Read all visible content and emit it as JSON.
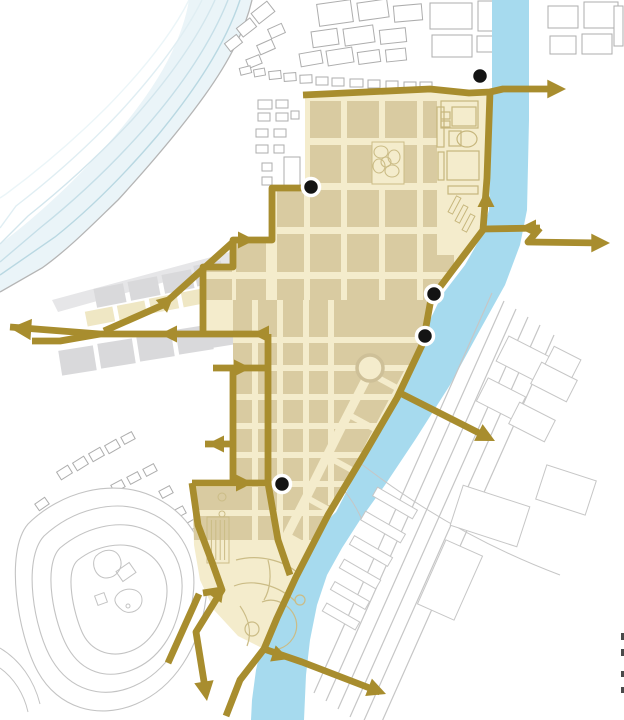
{
  "canvas": {
    "w": 624,
    "h": 720,
    "bg": "#FFFFFF"
  },
  "palette": {
    "route_gold": "#A88D2E",
    "river_blue": "#A6DAEE",
    "zone_cream": "#F4ECCC",
    "block_tan": "#D9CBA1",
    "block_gray": "#D9D9DB",
    "pier_wedge": "#E6E6E8",
    "block_beige": "#EFE7C4",
    "outline_gray": "#ADADAD",
    "contour_gray": "#C3C3C3",
    "rail_gray": "#C6C6C6",
    "feature_tan": "#CBBC86",
    "ne_outline": "#C6B67C",
    "shore_gray": "#B5B5B5",
    "dot_black": "#141414",
    "dot_ring": "#FFFFFF",
    "edge_mark": "#4A4A4A",
    "bay_fill": "#EAF4F8",
    "bay_blues": [
      "#B9D8E2",
      "#C6DFE8",
      "#D3E6ED",
      "#E0EEF3",
      "#EBF5F8"
    ]
  },
  "bay": {
    "fill_band": "M252,0 C245,30 230,60 205,95 C180,130 150,165 118,200 C95,222 70,248 42,268 L0,292 L0,244 C30,222 65,190 95,158 C125,126 155,88 172,52 C180,35 186,18 189,0 Z",
    "shoreline": "M252,0 C245,30 230,60 205,95 C180,130 150,165 118,200 C95,222 70,248 42,268 L0,292",
    "contours": [
      "M240,0 C225,45 195,90 158,135 C130,168 95,205 55,237 L0,275",
      "M228,0 C210,45 180,88 145,128 C115,162 80,196 40,228 L0,262",
      "M215,0 C196,42 166,82 132,120 C104,150 68,184 28,216 L0,244",
      "M202,0 C183,38 153,76 120,112 C92,142 55,176 16,206 L0,228",
      "M189,0 C171,36 141,72 108,106 C80,134 44,166 6,194 L0,198"
    ]
  },
  "river": {
    "path": "M492,0 L492,120 L489,210 L482,235 L465,265 L442,295 L430,320 L420,350 L398,395 L368,450 L336,512 L312,535 L294,558 L282,585 L272,612 L263,640 L256,670 L252,700 L251,720 L304,720 L306,675 L310,640 L317,605 L327,575 L342,548 L360,520 L385,485 L415,440 L450,385 L480,330 L505,285 L520,245 L527,210 L529,120 L529,0 Z"
  },
  "zone": {
    "outline": "305,92 490,92 487,178 483,230 452,271 431,299 423,343 397,398 362,458 328,515 296,577 277,618 264,649 238,636 214,610 200,580 194,545 192,483 233,483 233,336 203,336 203,267 233,267 233,240 272,240 272,188 305,188",
    "upper_cols": [
      [
        206,
        26
      ],
      [
        236,
        30
      ],
      [
        277,
        27
      ],
      [
        310,
        31
      ],
      [
        347,
        32
      ],
      [
        385,
        32
      ],
      [
        423,
        31
      ]
    ],
    "upper_rows": [
      [
        101,
        37
      ],
      [
        145,
        38
      ],
      [
        190,
        37
      ],
      [
        234,
        38
      ],
      [
        279,
        21
      ]
    ],
    "lower_fill": "233,300 431,300 423,343 397,398 362,458 330,510 312,540 194,540 192,483 233,483",
    "streets_v": [
      [
        255,
        300,
        540
      ],
      [
        280,
        300,
        540
      ],
      [
        306,
        300,
        540
      ],
      [
        331,
        300,
        505
      ]
    ],
    "streets_h": [
      [
        340,
        192,
        430
      ],
      [
        368,
        192,
        430
      ],
      [
        397,
        192,
        420
      ],
      [
        426,
        192,
        410
      ],
      [
        455,
        192,
        395
      ],
      [
        484,
        192,
        370
      ],
      [
        513,
        194,
        340
      ]
    ],
    "diag_avenues": [
      {
        "d": "M377,358 L341,428 L306,498 L282,545",
        "w": 9
      },
      {
        "d": "M409,368 L371,440 L339,503",
        "w": 6
      }
    ],
    "cross_streets": [
      "M373,375 L417,399",
      "M351,416 L395,440",
      "M330,458 L372,481",
      "M309,499 L349,521",
      "M290,537 L326,557"
    ]
  },
  "ne_area": {
    "rect": [
      437,
      95,
      52,
      160
    ],
    "shapes": [
      {
        "t": "rect",
        "v": [
          441,
          101,
          37,
          27
        ]
      },
      {
        "t": "rect",
        "v": [
          441,
          112,
          9,
          7
        ]
      },
      {
        "t": "rect",
        "v": [
          441,
          121,
          9,
          6
        ]
      },
      {
        "t": "rect",
        "v": [
          452,
          107,
          24,
          19
        ]
      },
      {
        "t": "ellipse",
        "v": [
          467,
          139,
          10,
          8
        ]
      },
      {
        "t": "rect",
        "v": [
          449,
          131,
          12,
          15
        ]
      },
      {
        "t": "rect",
        "v": [
          437,
          107,
          7,
          40
        ]
      },
      {
        "t": "rect",
        "v": [
          447,
          151,
          32,
          29
        ]
      },
      {
        "t": "rect",
        "v": [
          438,
          152,
          6,
          28
        ]
      },
      {
        "t": "rect",
        "v": [
          448,
          186,
          30,
          8
        ]
      }
    ],
    "hatch": [
      [
        452,
        196,
        5,
        18,
        28
      ],
      [
        459,
        205,
        5,
        18,
        28
      ],
      [
        466,
        214,
        5,
        18,
        28
      ]
    ]
  },
  "features": {
    "park_rect": [
      372,
      142,
      32,
      42
    ],
    "park_trees": [
      [
        381,
        152,
        7,
        6
      ],
      [
        394,
        157,
        6,
        7
      ],
      [
        379,
        166,
        6,
        7
      ],
      [
        392,
        171,
        7,
        6
      ],
      [
        386,
        162,
        5,
        5
      ]
    ],
    "plaza": [
      370,
      368,
      13
    ],
    "notch_building": [
      207,
      517,
      22,
      46
    ],
    "notch_circles": [
      [
        222,
        497,
        4
      ],
      [
        222,
        514,
        3
      ]
    ],
    "bottom_park_paths": [
      "M236,560 C258,554 284,560 299,574",
      "M234,586 C254,578 280,586 296,602",
      "M262,602 C276,596 292,606 296,620 C299,633 291,645 279,649",
      "M240,606 C249,619 252,633 247,646",
      "M268,560 C272,575 270,590 264,600"
    ],
    "bottom_park_circles": [
      [
        252,
        629,
        7
      ],
      [
        300,
        600,
        5
      ]
    ]
  },
  "buildings": {
    "top": [
      [
        318,
        2,
        34,
        22,
        -8
      ],
      [
        358,
        1,
        30,
        18,
        -8
      ],
      [
        394,
        5,
        28,
        16,
        -5
      ],
      [
        430,
        3,
        42,
        26,
        0
      ],
      [
        478,
        1,
        20,
        30,
        0
      ],
      [
        312,
        30,
        26,
        16,
        -8
      ],
      [
        344,
        27,
        30,
        17,
        -8
      ],
      [
        380,
        29,
        26,
        14,
        -6
      ],
      [
        432,
        35,
        40,
        22,
        0
      ],
      [
        477,
        36,
        20,
        16,
        0
      ],
      [
        300,
        52,
        22,
        13,
        -10
      ],
      [
        327,
        49,
        26,
        15,
        -9
      ],
      [
        358,
        51,
        22,
        12,
        -8
      ],
      [
        386,
        49,
        20,
        12,
        -6
      ]
    ],
    "topleft": [
      [
        253,
        6,
        20,
        13,
        -38
      ],
      [
        238,
        22,
        17,
        11,
        -38
      ],
      [
        226,
        38,
        15,
        10,
        -38
      ],
      [
        269,
        26,
        15,
        10,
        -24
      ],
      [
        258,
        42,
        16,
        10,
        -24
      ],
      [
        247,
        57,
        14,
        9,
        -22
      ]
    ],
    "midrow": [
      [
        240,
        67,
        11,
        7,
        -14
      ],
      [
        254,
        69,
        11,
        7,
        -10
      ],
      [
        269,
        71,
        12,
        8,
        -6
      ],
      [
        284,
        73,
        12,
        8,
        -4
      ],
      [
        300,
        75,
        12,
        8,
        -2
      ],
      [
        316,
        77,
        12,
        8,
        0
      ],
      [
        332,
        78,
        12,
        8,
        0
      ],
      [
        350,
        79,
        13,
        8,
        0
      ],
      [
        368,
        80,
        12,
        8,
        0
      ],
      [
        386,
        81,
        12,
        8,
        0
      ],
      [
        404,
        82,
        12,
        8,
        0
      ],
      [
        420,
        82,
        12,
        8,
        0
      ]
    ],
    "westcol": [
      [
        258,
        100,
        14,
        9,
        0
      ],
      [
        276,
        100,
        12,
        8,
        0
      ],
      [
        258,
        113,
        12,
        8,
        0
      ],
      [
        276,
        113,
        12,
        8,
        0
      ],
      [
        291,
        111,
        8,
        8,
        0
      ],
      [
        256,
        129,
        12,
        8,
        0
      ],
      [
        274,
        129,
        12,
        8,
        0
      ],
      [
        256,
        145,
        12,
        8,
        0
      ],
      [
        274,
        145,
        10,
        8,
        0
      ],
      [
        284,
        157,
        16,
        30,
        0
      ],
      [
        262,
        163,
        10,
        8,
        0
      ],
      [
        262,
        177,
        10,
        8,
        0
      ],
      [
        272,
        190,
        8,
        6,
        0
      ]
    ],
    "topright": [
      [
        548,
        6,
        30,
        22,
        0
      ],
      [
        584,
        2,
        34,
        26,
        0
      ],
      [
        550,
        36,
        26,
        18,
        0
      ],
      [
        582,
        34,
        30,
        20,
        0
      ],
      [
        614,
        6,
        9,
        40,
        0
      ]
    ],
    "houses": [
      [
        58,
        468,
        13,
        9,
        -32
      ],
      [
        74,
        459,
        13,
        9,
        -32
      ],
      [
        90,
        450,
        13,
        9,
        -30
      ],
      [
        106,
        442,
        13,
        9,
        -30
      ],
      [
        122,
        434,
        12,
        8,
        -28
      ],
      [
        112,
        482,
        12,
        8,
        -28
      ],
      [
        128,
        474,
        12,
        8,
        -28
      ],
      [
        144,
        466,
        12,
        8,
        -28
      ],
      [
        160,
        488,
        12,
        8,
        -28
      ],
      [
        146,
        500,
        11,
        8,
        -28
      ],
      [
        130,
        508,
        11,
        8,
        -28
      ],
      [
        160,
        516,
        11,
        8,
        -28
      ],
      [
        174,
        508,
        11,
        8,
        -28
      ],
      [
        188,
        520,
        11,
        8,
        -30
      ],
      [
        200,
        532,
        11,
        8,
        -30
      ],
      [
        176,
        540,
        11,
        8,
        -30
      ],
      [
        190,
        552,
        11,
        8,
        -30
      ],
      [
        204,
        564,
        10,
        7,
        -30
      ],
      [
        36,
        500,
        12,
        8,
        -35
      ],
      [
        48,
        512,
        11,
        8,
        -35
      ],
      [
        30,
        548,
        11,
        8,
        -20
      ],
      [
        22,
        576,
        11,
        8,
        -15
      ],
      [
        30,
        600,
        11,
        8,
        -12
      ],
      [
        24,
        628,
        10,
        7,
        -10
      ]
    ]
  },
  "pier": {
    "wedge": "52,300 230,252 236,262 58,312",
    "blocks": [
      {
        "v": [
          95,
          286,
          30,
          19,
          -11
        ],
        "c": "gray"
      },
      {
        "v": [
          129,
          279,
          30,
          19,
          -11
        ],
        "c": "gray"
      },
      {
        "v": [
          163,
          272,
          30,
          19,
          -11
        ],
        "c": "gray"
      },
      {
        "v": [
          195,
          263,
          28,
          21,
          -11
        ],
        "c": "gray"
      },
      {
        "v": [
          86,
          309,
          28,
          15,
          -11
        ],
        "c": "beige"
      },
      {
        "v": [
          118,
          303,
          28,
          15,
          -11
        ],
        "c": "beige"
      },
      {
        "v": [
          150,
          296,
          28,
          15,
          -11
        ],
        "c": "beige"
      },
      {
        "v": [
          182,
          290,
          26,
          15,
          -11
        ],
        "c": "beige"
      },
      {
        "v": [
          60,
          348,
          35,
          25,
          -9
        ],
        "c": "gray"
      },
      {
        "v": [
          99,
          341,
          35,
          25,
          -9
        ],
        "c": "gray"
      },
      {
        "v": [
          138,
          334,
          35,
          25,
          -9
        ],
        "c": "gray"
      },
      {
        "v": [
          177,
          327,
          35,
          25,
          -9
        ],
        "c": "gray"
      },
      {
        "v": [
          211,
          321,
          24,
          25,
          -9
        ],
        "c": "gray"
      }
    ]
  },
  "hill": {
    "contours": [
      "M28,524 C60,492 112,478 152,496 C192,514 212,552 206,598 C200,648 174,688 136,704 C98,720 58,708 38,672 C18,636 4,552 28,524 Z",
      "M44,536 C72,510 114,498 148,512 C182,526 198,558 193,596 C188,638 166,672 134,686 C102,700 70,690 52,660 C34,630 22,560 44,536 Z",
      "M60,548 C84,528 118,518 146,530 C174,542 186,568 181,600 C176,634 158,660 132,670 C106,680 82,672 68,648 C54,624 42,566 60,548 Z",
      "M78,560 C96,546 122,540 142,550 C162,560 170,580 166,602 C162,626 148,646 128,652 C108,658 90,650 82,632 C74,614 64,572 78,560 Z"
    ],
    "inner_paths": [
      "M96,556 C104,548 116,548 120,558 C124,568 116,578 106,578 C96,578 90,564 96,556 Z",
      "M120,592 C130,586 142,590 142,600 C142,610 130,616 122,610 C114,604 112,598 120,592 Z",
      "M0,648 C20,660 34,680 40,704",
      "M0,668 C14,678 24,694 28,712"
    ],
    "inner_rects": [
      [
        118,
        566,
        16,
        12,
        -35
      ],
      [
        96,
        594,
        10,
        10,
        -20
      ]
    ],
    "inner_dot": [
      128,
      606,
      2
    ]
  },
  "rail": {
    "lines": [
      [
        492,
        293,
        314,
        693
      ],
      [
        504,
        301,
        326,
        701
      ],
      [
        516,
        309,
        338,
        709
      ],
      [
        528,
        317,
        350,
        717
      ],
      [
        540,
        325,
        362,
        725
      ],
      [
        554,
        335,
        376,
        735
      ]
    ],
    "quads": [
      [
        500,
        345,
        46,
        28,
        27
      ],
      [
        534,
        370,
        40,
        24,
        27
      ],
      [
        480,
        386,
        42,
        26,
        27
      ],
      [
        512,
        410,
        40,
        24,
        27
      ],
      [
        548,
        352,
        30,
        20,
        27
      ],
      [
        455,
        495,
        70,
        42,
        18
      ],
      [
        540,
        472,
        52,
        36,
        18
      ],
      [
        430,
        545,
        40,
        70,
        24
      ]
    ],
    "thin": [
      [
        372,
        498,
        46,
        10,
        30
      ],
      [
        360,
        522,
        46,
        10,
        30
      ],
      [
        349,
        546,
        44,
        10,
        30
      ],
      [
        339,
        569,
        42,
        10,
        30
      ],
      [
        330,
        591,
        40,
        9,
        30
      ],
      [
        322,
        612,
        38,
        9,
        30
      ]
    ],
    "curves": [
      "M320,430 C400,500 480,545 560,575",
      "M300,455 C330,472 350,492 362,520"
    ]
  },
  "routes": [
    {
      "name": "perimeter-north",
      "d": "M303,95 L430,89 L469,93 L490,92 L503,89 L557,89"
    },
    {
      "name": "perimeter-river",
      "d": "M490,92 L487,178 L483,230 L452,271 L431,299 L423,343 L397,398 L362,458 L328,515 L296,577 L277,618 L264,649"
    },
    {
      "name": "perimeter-west-stairs",
      "d": "M312,188 L272,188 L272,240 L233,240 L233,267 L203,267 L203,336"
    },
    {
      "name": "west-artery",
      "d": "M268,334 L100,334 L10,327"
    },
    {
      "name": "west-artery-fork",
      "d": "M100,334 L60,341 L32,341"
    },
    {
      "name": "northwest-diagonal",
      "d": "M104,331 L163,305 L233,242"
    },
    {
      "name": "west-stub-368",
      "d": "M213,368 L268,368"
    },
    {
      "name": "west-boundary-lower",
      "d": "M233,368 L233,483"
    },
    {
      "name": "west-stub-443",
      "d": "M205,444 L233,444"
    },
    {
      "name": "inner-street-268",
      "d": "M268,334 L268,483 L278,540 L290,575"
    },
    {
      "name": "cross-street-483",
      "d": "M192,483 L270,483"
    },
    {
      "name": "southwest-route",
      "d": "M192,483 L198,525 L212,562 L222,590 L196,632 L206,694"
    },
    {
      "name": "southwest-stub",
      "d": "M222,590 L203,593"
    },
    {
      "name": "southwest-spur",
      "d": "M199,594 L168,663"
    },
    {
      "name": "south-exit-diagonal",
      "d": "M264,649 L240,680 L226,716"
    },
    {
      "name": "south-bridge",
      "d": "M264,649 L302,662 L380,692"
    },
    {
      "name": "east-bridge-in",
      "d": "M483,229 L540,228"
    },
    {
      "name": "east-bridge-out",
      "d": "M540,228 L528,242 L603,243"
    },
    {
      "name": "southeast-bridge",
      "d": "M402,394 L489,438"
    }
  ],
  "arrows": [
    [
      566,
      89,
      0,
      1.1
    ],
    [
      486,
      190,
      -90,
      1
    ],
    [
      519,
      228,
      180,
      1
    ],
    [
      610,
      243,
      0,
      1.1
    ],
    [
      495,
      441,
      27,
      1.1
    ],
    [
      255,
      240,
      0,
      1
    ],
    [
      10,
      328,
      184,
      1.25
    ],
    [
      160,
      334,
      180,
      1
    ],
    [
      252,
      334,
      180,
      1
    ],
    [
      174,
      295,
      -42,
      1
    ],
    [
      251,
      368,
      0,
      1
    ],
    [
      207,
      444,
      180,
      1
    ],
    [
      253,
      483,
      0,
      1
    ],
    [
      206,
      592,
      189,
      1
    ],
    [
      207,
      701,
      81,
      1.15
    ],
    [
      289,
      659,
      19,
      1
    ],
    [
      386,
      694,
      21,
      1.1
    ]
  ],
  "dots": [
    [
      480,
      76
    ],
    [
      311,
      187
    ],
    [
      434,
      294
    ],
    [
      425,
      336
    ],
    [
      282,
      484
    ]
  ],
  "edge_marks": [
    [
      621,
      633,
      3,
      7
    ],
    [
      621,
      649,
      3,
      7
    ],
    [
      621,
      671,
      3,
      6
    ],
    [
      621,
      687,
      3,
      6
    ]
  ]
}
